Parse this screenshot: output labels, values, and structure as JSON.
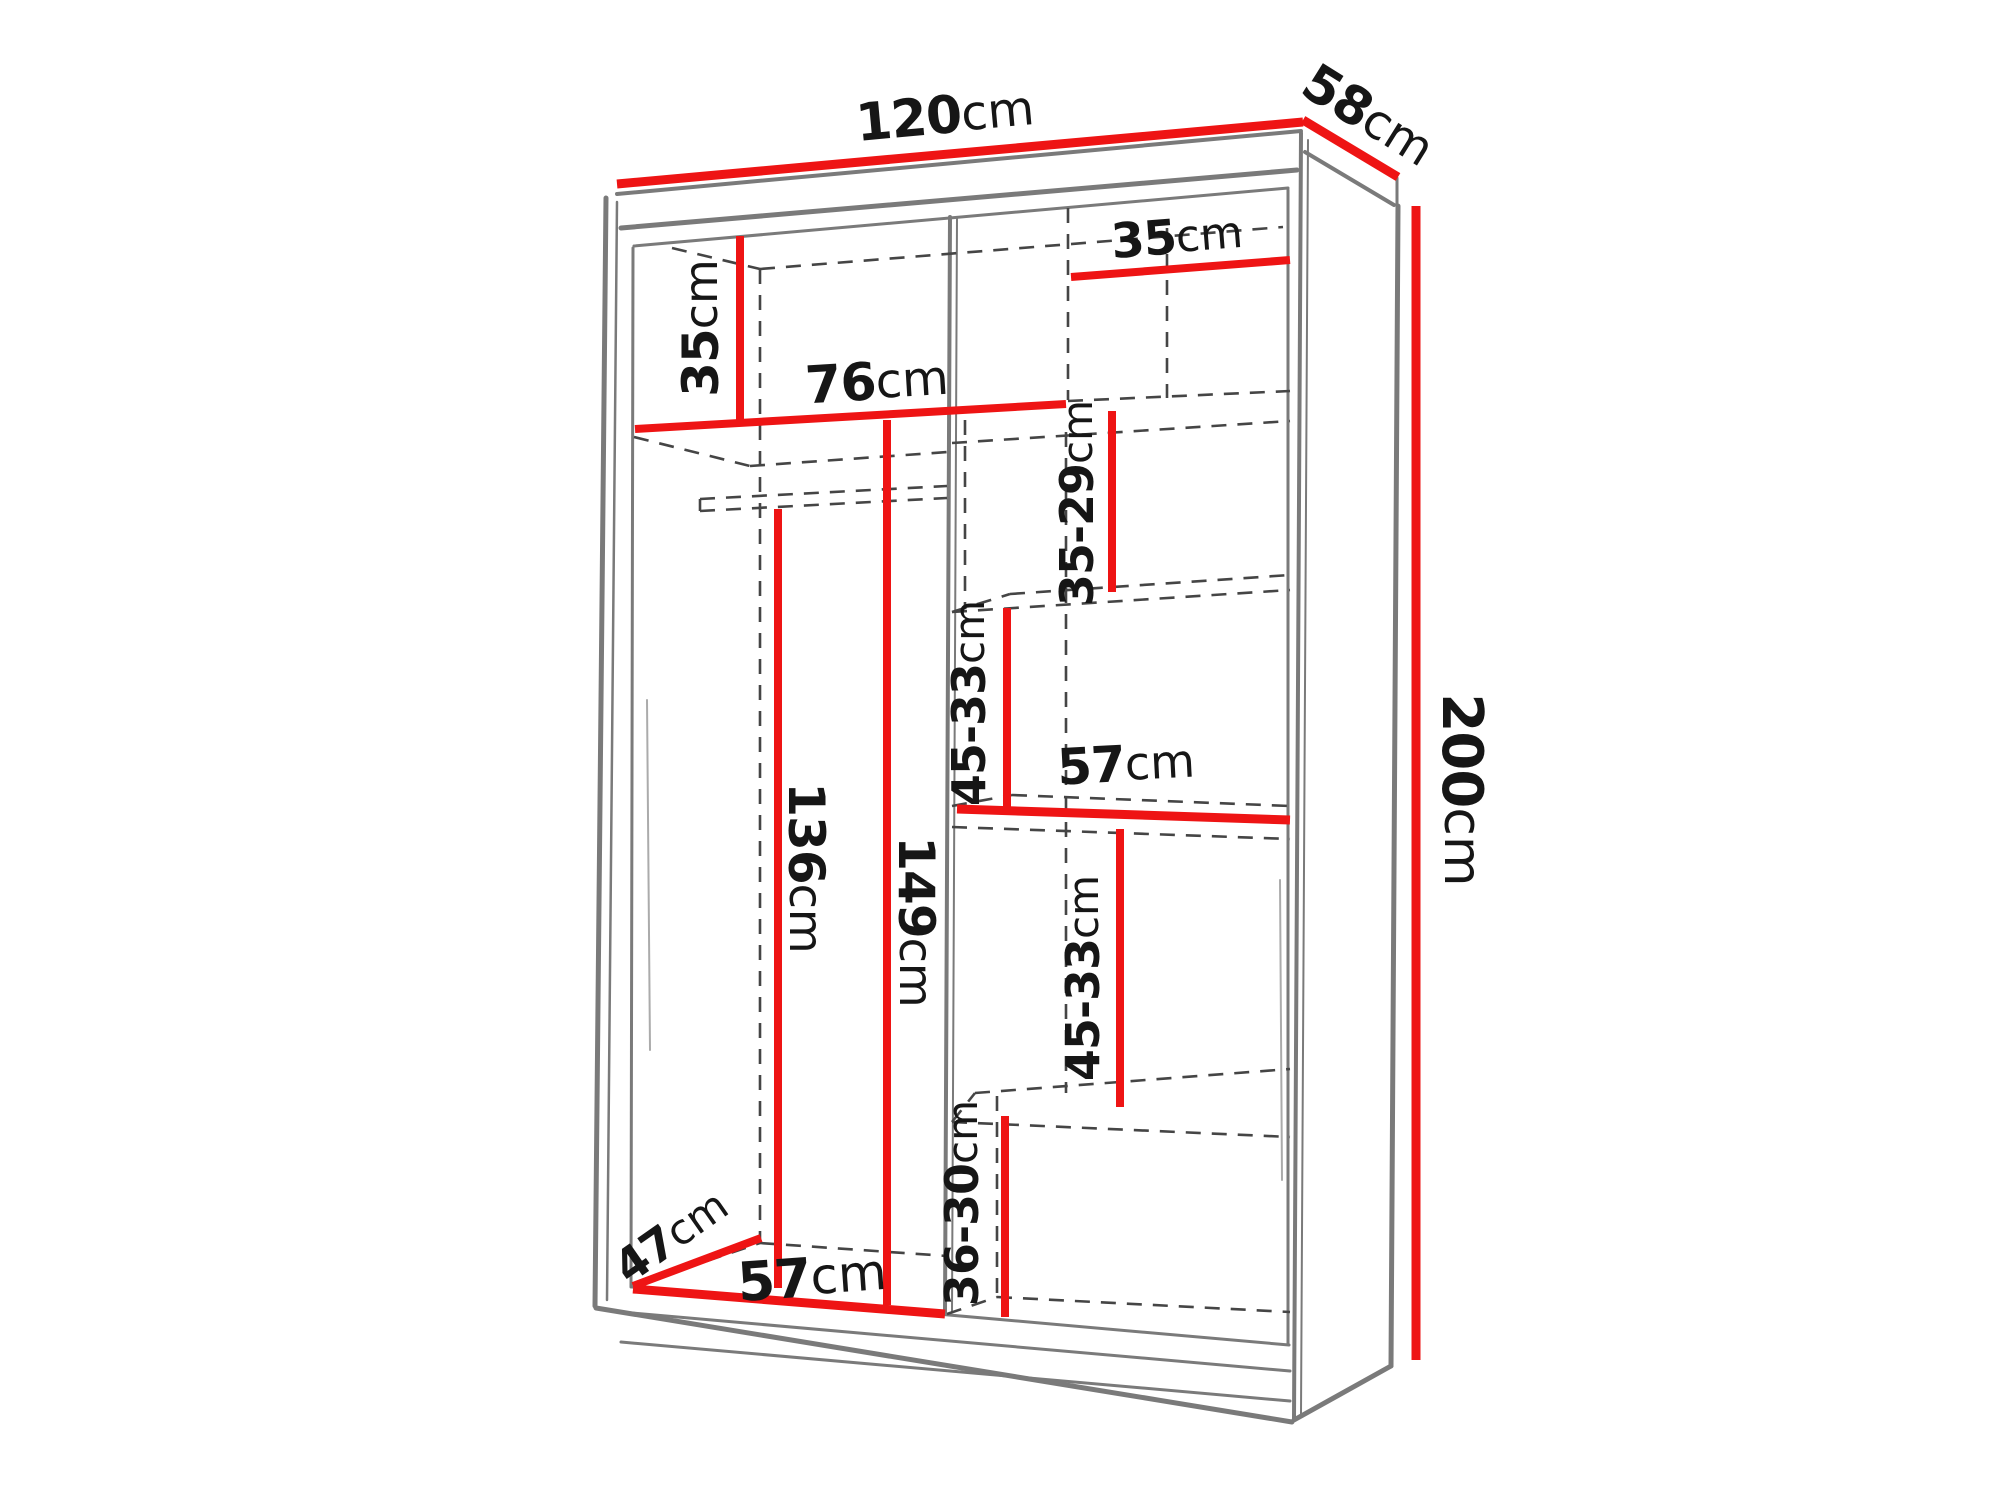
{
  "diagram": {
    "type": "furniture-dimension-diagram",
    "subject": "Two-door sliding wardrobe shown in perspective with internal shelf layout and dimension lines",
    "units": "cm",
    "overall": {
      "width": "120cm",
      "depth": "58cm",
      "height": "200cm"
    },
    "measurements": [
      {
        "name": "overall-width",
        "value": "120cm"
      },
      {
        "name": "overall-depth",
        "value": "58cm"
      },
      {
        "name": "overall-height",
        "value": "200cm"
      },
      {
        "name": "top-shelf-drop-left",
        "value": "35cm"
      },
      {
        "name": "top-left-opening-width",
        "value": "76cm"
      },
      {
        "name": "top-right-opening-width",
        "value": "35cm"
      },
      {
        "name": "upper-right-shelf-spacing",
        "value": "35-29cm"
      },
      {
        "name": "mid-right-shelf-spacing",
        "value": "45-33cm"
      },
      {
        "name": "middle-shelf-width",
        "value": "57cm"
      },
      {
        "name": "lower-right-shelf-spacing",
        "value": "45-33cm"
      },
      {
        "name": "bottom-right-shelf-spacing",
        "value": "36-30cm"
      },
      {
        "name": "hanging-space-height",
        "value": "136cm"
      },
      {
        "name": "left-opening-height",
        "value": "149cm"
      },
      {
        "name": "interior-depth",
        "value": "47cm"
      },
      {
        "name": "left-opening-width-bottom",
        "value": "57cm"
      }
    ]
  },
  "canvas": {
    "w": 2000,
    "h": 1500,
    "background": "#ffffff"
  },
  "colors": {
    "dimension": "#ee1414",
    "outline": "#7a7a7a",
    "outline_light": "#ababab",
    "dashed": "#454545",
    "text": "#161616"
  },
  "style": {
    "dash_pattern": "15 11",
    "dashed_width": 2.6
  },
  "outline_lines": [
    {
      "name": "top-edge",
      "x1": 617,
      "y1": 194,
      "x2": 1301,
      "y2": 131,
      "w": 4
    },
    {
      "name": "top-band-bottom-edge",
      "x1": 621,
      "y1": 228,
      "x2": 1297,
      "y2": 170,
      "w": 5
    },
    {
      "name": "ceiling-edge",
      "x1": 634,
      "y1": 246,
      "x2": 1288,
      "y2": 188,
      "w": 3
    },
    {
      "name": "left-outer-edge",
      "x1": 606,
      "y1": 198,
      "x2": 595,
      "y2": 1306,
      "w": 5
    },
    {
      "name": "left-outer-edge-inner",
      "x1": 617,
      "y1": 202,
      "x2": 607,
      "y2": 1300,
      "w": 2.5
    },
    {
      "name": "left-inner-wall",
      "x1": 633,
      "y1": 248,
      "x2": 631,
      "y2": 1287,
      "w": 3
    },
    {
      "name": "front-right-edge",
      "x1": 1301,
      "y1": 133,
      "x2": 1294,
      "y2": 1419,
      "w": 4
    },
    {
      "name": "front-right-edge-inner",
      "x1": 1308,
      "y1": 140,
      "x2": 1301,
      "y2": 1414,
      "w": 2
    },
    {
      "name": "right-inner-wall",
      "x1": 1288,
      "y1": 190,
      "x2": 1288,
      "y2": 1344,
      "w": 3
    },
    {
      "name": "side-top-edge",
      "x1": 1305,
      "y1": 152,
      "x2": 1394,
      "y2": 205,
      "w": 4
    },
    {
      "name": "back-top-corner-edge",
      "x1": 1397,
      "y1": 178,
      "x2": 1397,
      "y2": 206,
      "w": 3
    },
    {
      "name": "right-outer-edge",
      "x1": 1398,
      "y1": 206,
      "x2": 1391,
      "y2": 1366,
      "w": 5
    },
    {
      "name": "side-bottom-edge",
      "x1": 1391,
      "y1": 1366,
      "x2": 1294,
      "y2": 1420,
      "w": 5
    },
    {
      "name": "bottom-outer-edge",
      "x1": 596,
      "y1": 1308,
      "x2": 1292,
      "y2": 1422,
      "w": 5
    },
    {
      "name": "floor-front-edge",
      "x1": 632,
      "y1": 1287,
      "x2": 1289,
      "y2": 1345,
      "w": 3
    },
    {
      "name": "plinth-line-upper",
      "x1": 621,
      "y1": 1312,
      "x2": 1290,
      "y2": 1371,
      "w": 3
    },
    {
      "name": "plinth-line-lower",
      "x1": 621,
      "y1": 1342,
      "x2": 1290,
      "y2": 1401,
      "w": 3
    },
    {
      "name": "center-divider-front",
      "x1": 950,
      "y1": 217,
      "x2": 945,
      "y2": 1312,
      "w": 4
    },
    {
      "name": "center-divider-front-inner",
      "x1": 957,
      "y1": 218,
      "x2": 952,
      "y2": 1312,
      "w": 2
    },
    {
      "name": "door-glint-left",
      "x1": 647,
      "y1": 700,
      "x2": 650,
      "y2": 1050,
      "w": 2,
      "light": true
    },
    {
      "name": "door-glint-right",
      "x1": 1280,
      "y1": 880,
      "x2": 1282,
      "y2": 1180,
      "w": 2,
      "light": true
    }
  ],
  "dashed_lines": [
    {
      "name": "ceiling-back-diagonal",
      "x1": 672,
      "y1": 248,
      "x2": 760,
      "y2": 269
    },
    {
      "name": "ceiling-back-edge",
      "x1": 760,
      "y1": 269,
      "x2": 1283,
      "y2": 227
    },
    {
      "name": "top-right-shelf-back",
      "x1": 1068,
      "y1": 401,
      "x2": 1290,
      "y2": 391
    },
    {
      "name": "top-right-shelf-front",
      "x1": 952,
      "y1": 443,
      "x2": 1290,
      "y2": 421
    },
    {
      "name": "left-shelf-back-diagonal",
      "x1": 634,
      "y1": 437,
      "x2": 750,
      "y2": 466
    },
    {
      "name": "left-shelf-back-edge",
      "x1": 750,
      "y1": 466,
      "x2": 948,
      "y2": 452
    },
    {
      "name": "hanging-rod-top",
      "x1": 700,
      "y1": 499,
      "x2": 947,
      "y2": 486
    },
    {
      "name": "hanging-rod-bottom",
      "x1": 700,
      "y1": 511,
      "x2": 947,
      "y2": 498
    },
    {
      "name": "hanging-rod-end",
      "x1": 700,
      "y1": 499,
      "x2": 700,
      "y2": 511
    },
    {
      "name": "back-left-corner-line",
      "x1": 760,
      "y1": 269,
      "x2": 760,
      "y2": 1243
    },
    {
      "name": "floor-left-back-edge",
      "x1": 760,
      "y1": 1243,
      "x2": 947,
      "y2": 1256
    },
    {
      "name": "floor-left-diagonal",
      "x1": 633,
      "y1": 1286,
      "x2": 760,
      "y2": 1243
    },
    {
      "name": "divider-back-top",
      "x1": 1068,
      "y1": 208,
      "x2": 1068,
      "y2": 400
    },
    {
      "name": "divider-back-mid",
      "x1": 1066,
      "y1": 432,
      "x2": 1066,
      "y2": 1093
    },
    {
      "name": "column-back-line",
      "x1": 965,
      "y1": 420,
      "x2": 965,
      "y2": 608
    },
    {
      "name": "partition-back-top",
      "x1": 1167,
      "y1": 228,
      "x2": 1167,
      "y2": 398
    },
    {
      "name": "shelf-b-front",
      "x1": 952,
      "y1": 612,
      "x2": 1290,
      "y2": 590
    },
    {
      "name": "shelf-b-back",
      "x1": 1010,
      "y1": 594,
      "x2": 1290,
      "y2": 575
    },
    {
      "name": "shelf-b-diagonal",
      "x1": 952,
      "y1": 612,
      "x2": 1010,
      "y2": 594
    },
    {
      "name": "shelf-c-back",
      "x1": 1012,
      "y1": 795,
      "x2": 1290,
      "y2": 806
    },
    {
      "name": "shelf-c-diagonal",
      "x1": 952,
      "y1": 806,
      "x2": 1012,
      "y2": 795
    },
    {
      "name": "shelf-c-front",
      "x1": 952,
      "y1": 827,
      "x2": 1290,
      "y2": 839
    },
    {
      "name": "shelf-d-back",
      "x1": 975,
      "y1": 1093,
      "x2": 1290,
      "y2": 1069
    },
    {
      "name": "shelf-d-diagonal",
      "x1": 952,
      "y1": 1122,
      "x2": 975,
      "y2": 1093
    },
    {
      "name": "shelf-d-front",
      "x1": 952,
      "y1": 1122,
      "x2": 1290,
      "y2": 1137
    },
    {
      "name": "corner-line-bottom-right",
      "x1": 997,
      "y1": 1096,
      "x2": 997,
      "y2": 1297
    },
    {
      "name": "floor-right-back-edge",
      "x1": 997,
      "y1": 1297,
      "x2": 1290,
      "y2": 1312
    },
    {
      "name": "floor-right-diagonal",
      "x1": 947,
      "y1": 1314,
      "x2": 997,
      "y2": 1297
    }
  ],
  "red_lines": [
    {
      "name": "dim-line-width-120",
      "x1": 617,
      "y1": 184,
      "x2": 1303,
      "y2": 122,
      "w": 9
    },
    {
      "name": "dim-line-depth-58",
      "x1": 1303,
      "y1": 120,
      "x2": 1398,
      "y2": 177,
      "w": 9
    },
    {
      "name": "dim-line-height-200",
      "x1": 1416,
      "y1": 206,
      "x2": 1416,
      "y2": 1360,
      "w": 9
    },
    {
      "name": "dim-line-top-left-35",
      "x1": 740,
      "y1": 236,
      "x2": 740,
      "y2": 423,
      "w": 8
    },
    {
      "name": "dim-line-76",
      "x1": 635,
      "y1": 429,
      "x2": 1066,
      "y2": 404,
      "w": 8
    },
    {
      "name": "dim-line-top-right-35",
      "x1": 1071,
      "y1": 277,
      "x2": 1290,
      "y2": 260,
      "w": 8
    },
    {
      "name": "dim-line-35-29",
      "x1": 1112,
      "y1": 411,
      "x2": 1112,
      "y2": 592,
      "w": 8
    },
    {
      "name": "dim-line-45-33-upper",
      "x1": 1007,
      "y1": 608,
      "x2": 1007,
      "y2": 810,
      "w": 8
    },
    {
      "name": "dim-line-57-middle",
      "x1": 957,
      "y1": 809,
      "x2": 1290,
      "y2": 820,
      "w": 9
    },
    {
      "name": "dim-line-45-33-lower",
      "x1": 1120,
      "y1": 829,
      "x2": 1120,
      "y2": 1107,
      "w": 8
    },
    {
      "name": "dim-line-36-30",
      "x1": 1005,
      "y1": 1116,
      "x2": 1005,
      "y2": 1317,
      "w": 8
    },
    {
      "name": "dim-line-136",
      "x1": 778,
      "y1": 509,
      "x2": 778,
      "y2": 1288,
      "w": 8
    },
    {
      "name": "dim-line-149",
      "x1": 887,
      "y1": 420,
      "x2": 887,
      "y2": 1305,
      "w": 8
    },
    {
      "name": "dim-line-depth-47",
      "x1": 633,
      "y1": 1286,
      "x2": 761,
      "y2": 1238,
      "w": 8
    },
    {
      "name": "dim-line-57-bottom",
      "x1": 633,
      "y1": 1289,
      "x2": 945,
      "y2": 1314,
      "w": 9
    }
  ],
  "labels": [
    {
      "name": "dim-label-width-120",
      "num": "120",
      "unit": "cm",
      "x": 945,
      "y": 116,
      "rot": -5.2,
      "size": 52
    },
    {
      "name": "dim-label-depth-58",
      "num": "58",
      "unit": "cm",
      "x": 1368,
      "y": 116,
      "rot": 32,
      "size": 52
    },
    {
      "name": "dim-label-height-200",
      "num": "200",
      "unit": "cm",
      "x": 1462,
      "y": 790,
      "rot": 90,
      "size": 56
    },
    {
      "name": "dim-label-top-left-35",
      "num": "35",
      "unit": "cm",
      "x": 701,
      "y": 328,
      "rot": -90,
      "size": 50
    },
    {
      "name": "dim-label-76",
      "num": "76",
      "unit": "cm",
      "x": 877,
      "y": 382,
      "rot": -3.5,
      "size": 52
    },
    {
      "name": "dim-label-top-right-35",
      "num": "35",
      "unit": "cm",
      "x": 1177,
      "y": 237,
      "rot": -4.5,
      "size": 48
    },
    {
      "name": "dim-label-35-29",
      "num": "35-29",
      "unit": "cm",
      "x": 1077,
      "y": 503,
      "rot": -90,
      "size": 46
    },
    {
      "name": "dim-label-45-33-upper",
      "num": "45-33",
      "unit": "cm",
      "x": 969,
      "y": 703,
      "rot": -90,
      "size": 46
    },
    {
      "name": "dim-label-57-middle",
      "num": "57",
      "unit": "cm",
      "x": 1126,
      "y": 764,
      "rot": -3,
      "size": 50
    },
    {
      "name": "dim-label-45-33-lower",
      "num": "45-33",
      "unit": "cm",
      "x": 1083,
      "y": 978,
      "rot": -90,
      "size": 46
    },
    {
      "name": "dim-label-36-30",
      "num": "36-30",
      "unit": "cm",
      "x": 962,
      "y": 1203,
      "rot": -90,
      "size": 46
    },
    {
      "name": "dim-label-136",
      "num": "136",
      "unit": "cm",
      "x": 806,
      "y": 868,
      "rot": 90,
      "size": 50
    },
    {
      "name": "dim-label-149",
      "num": "149",
      "unit": "cm",
      "x": 916,
      "y": 922,
      "rot": 90,
      "size": 50
    },
    {
      "name": "dim-label-depth-47",
      "num": "47",
      "unit": "cm",
      "x": 671,
      "y": 1236,
      "rot": -35,
      "size": 46
    },
    {
      "name": "dim-label-57-bottom",
      "num": "57",
      "unit": "cm",
      "x": 812,
      "y": 1277,
      "rot": -4,
      "size": 54
    }
  ]
}
